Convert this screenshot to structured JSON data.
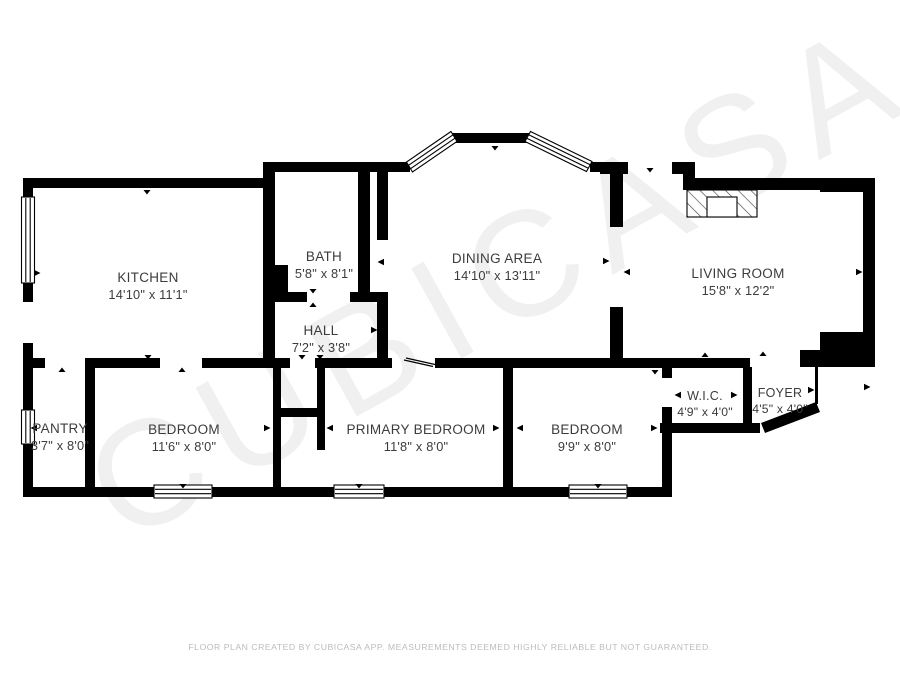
{
  "rooms": [
    {
      "name": "KITCHEN",
      "dims": "14'10\" x 11'1\""
    },
    {
      "name": "BATH",
      "dims": "5'8\" x 8'1\""
    },
    {
      "name": "DINING AREA",
      "dims": "14'10\" x 13'11\""
    },
    {
      "name": "LIVING ROOM",
      "dims": "15'8\" x 12'2\""
    },
    {
      "name": "HALL",
      "dims": "7'2\" x 3'8\""
    },
    {
      "name": "PANTRY",
      "dims": "3'7\" x 8'0\""
    },
    {
      "name": "BEDROOM",
      "dims": "11'6\" x 8'0\""
    },
    {
      "name": "PRIMARY BEDROOM",
      "dims": "11'8\" x 8'0\""
    },
    {
      "name": "BEDROOM",
      "dims": "9'9\" x 8'0\""
    },
    {
      "name": "W.I.C.",
      "dims": "4'9\" x 4'0\""
    },
    {
      "name": "FOYER",
      "dims": "4'5\" x 4'0\""
    }
  ],
  "watermark": {
    "text": "CUBICASA"
  },
  "footer": {
    "disclaimer": "FLOOR PLAN CREATED BY CUBICASA APP. MEASUREMENTS DEEMED HIGHLY RELIABLE BUT NOT GUARANTEED."
  },
  "colors": {
    "wall": "#000000",
    "label": "#3c3c3c",
    "footer_text": "#bcbcbc",
    "background": "#ffffff"
  }
}
